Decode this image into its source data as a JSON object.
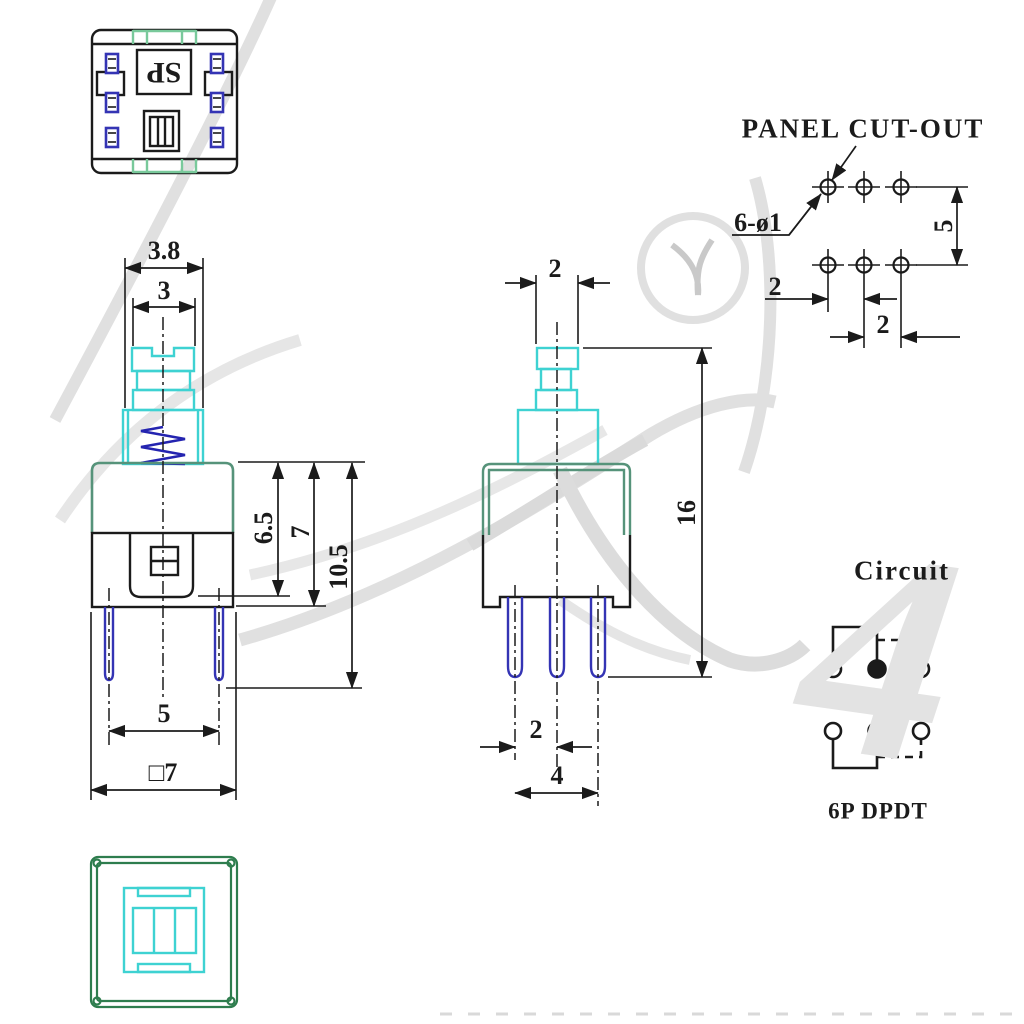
{
  "drawing": {
    "top_marking": "SP",
    "front": {
      "dim_knob_outer": "3.8",
      "dim_knob_inner": "3",
      "dim_body_upper": "6.5",
      "dim_body_height": "7",
      "dim_to_pin_end": "10.5",
      "dim_pin_spacing": "5",
      "dim_body_width": "□7"
    },
    "side": {
      "dim_tip_width": "2",
      "dim_total_height": "16",
      "dim_pin_pitch": "2",
      "dim_pin_span": "4"
    },
    "panel": {
      "title": "PANEL CUT-OUT",
      "hole_spec": "6-ø1",
      "dim_row_spacing": "5",
      "dim_col_pitch_a": "2",
      "dim_col_pitch_b": "2"
    },
    "circuit": {
      "title": "Circuit",
      "type_label": "6P DPDT"
    },
    "watermark_glyph": "4"
  },
  "colors": {
    "line_black": "#1b1b1b",
    "plunger_cyan": "#3ed2d2",
    "body_green": "#56937a",
    "bottom_view_green": "#2e7d4e",
    "top_view_green": "#79c99b",
    "pin_blue": "#3434b4",
    "spring_blue": "#2424b0",
    "watermark_gray": "#e0e0e0"
  }
}
